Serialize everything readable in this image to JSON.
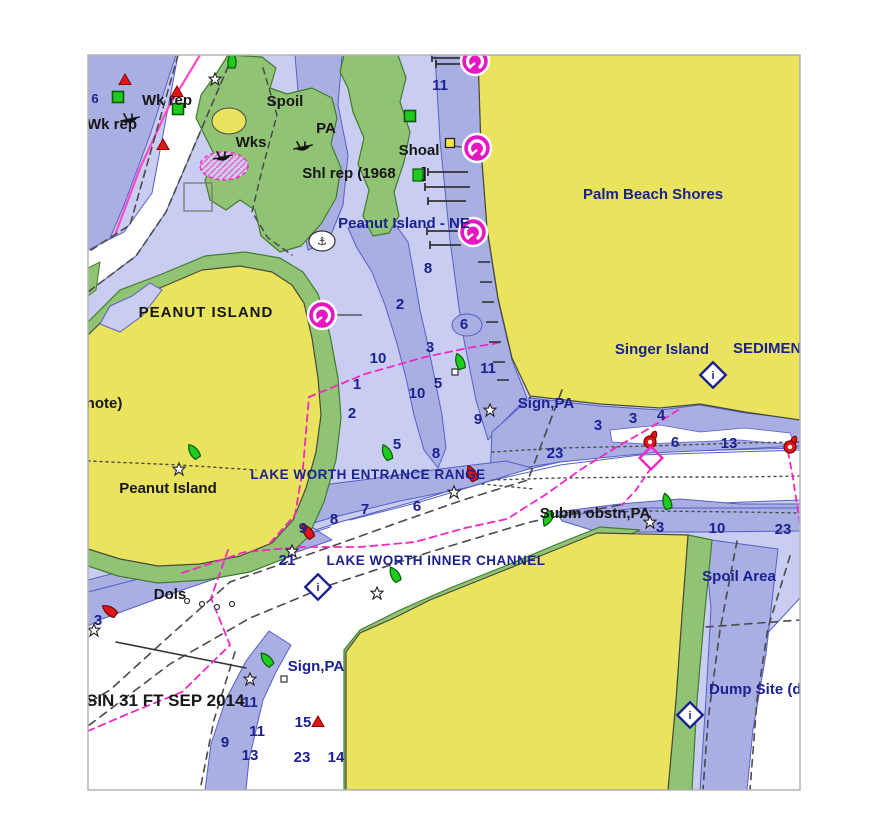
{
  "map": {
    "title": "Lake Worth Inlet nautical chart",
    "palette": {
      "land": "#e9e35e",
      "intertidal_green": "#90c474",
      "shallow_water": "#a9aee3",
      "mid_water": "#c9cdf1",
      "deep_water": "#ffffff",
      "contour": "#5560c5",
      "label_navy": "#1b2190",
      "label_black": "#161616",
      "magenta": "#f127c3",
      "buoy_red": "#e01515",
      "buoy_green": "#1ecb1e",
      "dash_gray": "#4a4a4a",
      "beacon_yellow": "#f5e54a"
    },
    "place_labels": [
      {
        "text": "6",
        "x": 95,
        "y": 103,
        "color": "navy",
        "size": 13
      },
      {
        "text": "Wk rep",
        "x": 167,
        "y": 105,
        "color": "black",
        "size": 15
      },
      {
        "text": "Wk rep",
        "x": 112,
        "y": 129,
        "color": "black",
        "size": 15
      },
      {
        "text": "Spoil",
        "x": 285,
        "y": 106,
        "color": "black",
        "size": 15
      },
      {
        "text": "Wks",
        "x": 251,
        "y": 147,
        "color": "black",
        "size": 15
      },
      {
        "text": "PA",
        "x": 326,
        "y": 133,
        "color": "black",
        "size": 15
      },
      {
        "text": "Shoal",
        "x": 419,
        "y": 155,
        "color": "black",
        "size": 15
      },
      {
        "text": "Shl rep (1968",
        "x": 349,
        "y": 178,
        "color": "black",
        "size": 15
      },
      {
        "text": "]",
        "x": 424,
        "y": 178,
        "color": "black",
        "size": 15
      },
      {
        "text": "Peanut Island - NE",
        "x": 404,
        "y": 228,
        "color": "navy",
        "size": 15
      },
      {
        "text": "Palm Beach Shores",
        "x": 653,
        "y": 199,
        "color": "navy",
        "size": 15
      },
      {
        "text": "PEANUT ISLAND",
        "x": 206,
        "y": 317,
        "color": "black",
        "size": 15,
        "spacing": 1
      },
      {
        "text": "note)",
        "x": 104,
        "y": 408,
        "color": "black",
        "size": 15
      },
      {
        "text": "Singer Island",
        "x": 662,
        "y": 354,
        "color": "navy",
        "size": 15
      },
      {
        "text": "SEDIMENT",
        "x": 733,
        "y": 353,
        "color": "navy",
        "size": 15,
        "anchor": "start"
      },
      {
        "text": "Sign,PA",
        "x": 546,
        "y": 408,
        "color": "navy",
        "size": 15
      },
      {
        "text": "Peanut Island",
        "x": 168,
        "y": 493,
        "color": "black",
        "size": 15
      },
      {
        "text": "LAKE WORTH ENTRANCE RANGE",
        "x": 368,
        "y": 479,
        "color": "navy",
        "size": 13.5,
        "spacing": 0.5
      },
      {
        "text": "Subm obstn,PA",
        "x": 595,
        "y": 518,
        "color": "black",
        "size": 15
      },
      {
        "text": "LAKE WORTH INNER CHANNEL",
        "x": 436,
        "y": 565,
        "color": "navy",
        "size": 13.5,
        "spacing": 0.5
      },
      {
        "text": "Spoil Area",
        "x": 739,
        "y": 581,
        "color": "navy",
        "size": 15
      },
      {
        "text": "Dols",
        "x": 170,
        "y": 599,
        "color": "black",
        "size": 15
      },
      {
        "text": "Sign,PA",
        "x": 316,
        "y": 671,
        "color": "navy",
        "size": 15
      },
      {
        "text": "SIN 31 FT SEP 2014",
        "x": 86,
        "y": 706,
        "color": "black",
        "size": 17,
        "anchor": "start"
      },
      {
        "text": "Dump Site (di",
        "x": 709,
        "y": 694,
        "color": "navy",
        "size": 15,
        "anchor": "start"
      }
    ],
    "depth_labels": [
      {
        "v": "11",
        "x": 440,
        "y": 90
      },
      {
        "v": "8",
        "x": 428,
        "y": 273
      },
      {
        "v": "2",
        "x": 400,
        "y": 309
      },
      {
        "v": "6",
        "x": 464,
        "y": 329
      },
      {
        "v": "3",
        "x": 430,
        "y": 352
      },
      {
        "v": "10",
        "x": 378,
        "y": 363
      },
      {
        "v": "1",
        "x": 357,
        "y": 389
      },
      {
        "v": "5",
        "x": 438,
        "y": 388
      },
      {
        "v": "11",
        "x": 488,
        "y": 373
      },
      {
        "v": "10",
        "x": 417,
        "y": 398
      },
      {
        "v": "2",
        "x": 352,
        "y": 418
      },
      {
        "v": "9",
        "x": 478,
        "y": 424
      },
      {
        "v": "5",
        "x": 397,
        "y": 449
      },
      {
        "v": "8",
        "x": 436,
        "y": 458
      },
      {
        "v": "7",
        "x": 365,
        "y": 514
      },
      {
        "v": "6",
        "x": 417,
        "y": 511
      },
      {
        "v": "8",
        "x": 334,
        "y": 524
      },
      {
        "v": "9",
        "x": 303,
        "y": 533
      },
      {
        "v": "21",
        "x": 287,
        "y": 565
      },
      {
        "v": "23",
        "x": 555,
        "y": 458
      },
      {
        "v": "3",
        "x": 598,
        "y": 430
      },
      {
        "v": "3",
        "x": 633,
        "y": 423
      },
      {
        "v": "4",
        "x": 661,
        "y": 420
      },
      {
        "v": "6",
        "x": 675,
        "y": 447
      },
      {
        "v": "13",
        "x": 729,
        "y": 448
      },
      {
        "v": "3",
        "x": 660,
        "y": 532
      },
      {
        "v": "10",
        "x": 717,
        "y": 533
      },
      {
        "v": "23",
        "x": 783,
        "y": 534
      },
      {
        "v": "3",
        "x": 98,
        "y": 625
      },
      {
        "v": "11",
        "x": 250,
        "y": 707
      },
      {
        "v": "11",
        "x": 257,
        "y": 736
      },
      {
        "v": "9",
        "x": 225,
        "y": 747
      },
      {
        "v": "13",
        "x": 250,
        "y": 760
      },
      {
        "v": "23",
        "x": 302,
        "y": 762
      },
      {
        "v": "14",
        "x": 336,
        "y": 762
      },
      {
        "v": "15",
        "x": 303,
        "y": 727
      }
    ],
    "buoys": [
      {
        "type": "can",
        "x": 232,
        "y": 61,
        "rot": 0
      },
      {
        "type": "can",
        "x": 194,
        "y": 452,
        "rot": -35
      },
      {
        "type": "can",
        "x": 460,
        "y": 362,
        "rot": -20
      },
      {
        "type": "can",
        "x": 387,
        "y": 453,
        "rot": -25
      },
      {
        "type": "can",
        "x": 395,
        "y": 575,
        "rot": -30
      },
      {
        "type": "can",
        "x": 267,
        "y": 660,
        "rot": -40
      },
      {
        "type": "can",
        "x": 548,
        "y": 518,
        "rot": 205
      },
      {
        "type": "can",
        "x": 667,
        "y": 502,
        "rot": -15
      },
      {
        "type": "nun",
        "x": 110,
        "y": 611,
        "rot": -55
      },
      {
        "type": "nun",
        "x": 308,
        "y": 532,
        "rot": -35
      },
      {
        "type": "nun",
        "x": 472,
        "y": 474,
        "rot": -25
      },
      {
        "type": "lighted",
        "x": 650,
        "y": 442,
        "rot": 0
      },
      {
        "type": "lighted",
        "x": 790,
        "y": 447,
        "rot": 0
      }
    ],
    "danger_triangles": [
      {
        "x": 125,
        "y": 80
      },
      {
        "x": 177,
        "y": 92
      },
      {
        "x": 163,
        "y": 145
      },
      {
        "x": 318,
        "y": 722
      }
    ],
    "mark_squares": [
      {
        "x": 118,
        "y": 97
      },
      {
        "x": 178,
        "y": 109
      },
      {
        "x": 410,
        "y": 116
      }
    ],
    "position_stars": [
      {
        "x": 215,
        "y": 79
      },
      {
        "x": 179,
        "y": 469
      },
      {
        "x": 454,
        "y": 492
      },
      {
        "x": 292,
        "y": 551
      },
      {
        "x": 377,
        "y": 593
      },
      {
        "x": 650,
        "y": 522
      },
      {
        "x": 94,
        "y": 630
      },
      {
        "x": 250,
        "y": 679
      },
      {
        "x": 490,
        "y": 410
      }
    ],
    "marina_icons": [
      {
        "x": 475,
        "y": 61
      },
      {
        "x": 477,
        "y": 148
      },
      {
        "x": 473,
        "y": 232
      },
      {
        "x": 322,
        "y": 315
      }
    ],
    "info_icons": [
      {
        "x": 713,
        "y": 375
      },
      {
        "x": 318,
        "y": 587
      },
      {
        "x": 690,
        "y": 715
      }
    ],
    "wreck_icons": [
      {
        "x": 130,
        "y": 119
      },
      {
        "x": 223,
        "y": 157
      },
      {
        "x": 303,
        "y": 147
      }
    ],
    "anchorage_icon": {
      "x": 322,
      "y": 241,
      "glyph": "⚓"
    },
    "note_icon": {
      "x": 413,
      "y": 169
    },
    "beacon_square": {
      "x": 450,
      "y": 143
    },
    "small_squares": [
      {
        "x": 284,
        "y": 679
      },
      {
        "x": 455,
        "y": 372
      }
    ],
    "junction_diamond": {
      "x": 651,
      "y": 458
    }
  }
}
